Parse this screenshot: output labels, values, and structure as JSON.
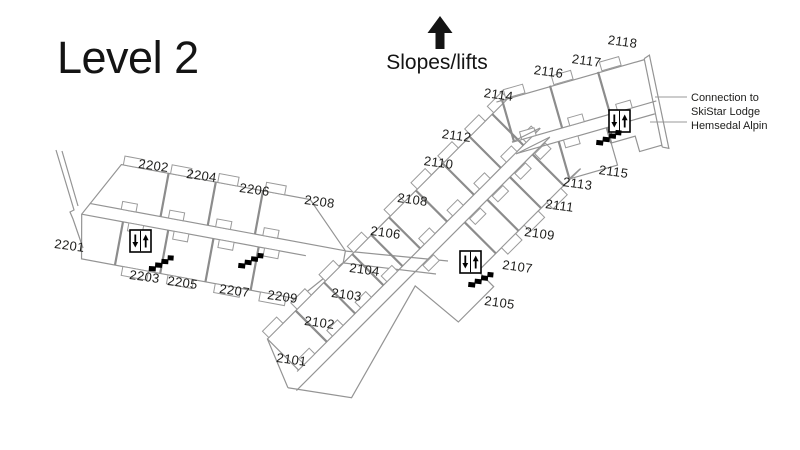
{
  "page": {
    "title": "Level 2",
    "background": "#ffffff"
  },
  "legend": {
    "slopes_label": "Slopes/lifts"
  },
  "connection": {
    "lines": [
      "Connection to",
      "SkiStar Lodge",
      "Hemsedal Alpin"
    ]
  },
  "rooms": {
    "r2101": "2101",
    "r2102": "2102",
    "r2103": "2103",
    "r2104": "2104",
    "r2105": "2105",
    "r2106": "2106",
    "r2107": "2107",
    "r2108": "2108",
    "r2109": "2109",
    "r2110": "2110",
    "r2111": "2111",
    "r2112": "2112",
    "r2113": "2113",
    "r2114": "2114",
    "r2115": "2115",
    "r2116": "2116",
    "r2117": "2117",
    "r2118": "2118",
    "r2201": "2201",
    "r2202": "2202",
    "r2203": "2203",
    "r2204": "2204",
    "r2205": "2205",
    "r2206": "2206",
    "r2207": "2207",
    "r2208": "2208",
    "r2209": "2209"
  },
  "icons": {
    "elevator": "elevator-up-down-arrows",
    "stairs": "staircase-steps",
    "slopes_arrow": "arrow-up"
  },
  "colors": {
    "wall": "#949494",
    "wall_thick": "#8c8c8c",
    "text": "#1d1d1b",
    "icon": "#000000",
    "background": "#ffffff"
  }
}
